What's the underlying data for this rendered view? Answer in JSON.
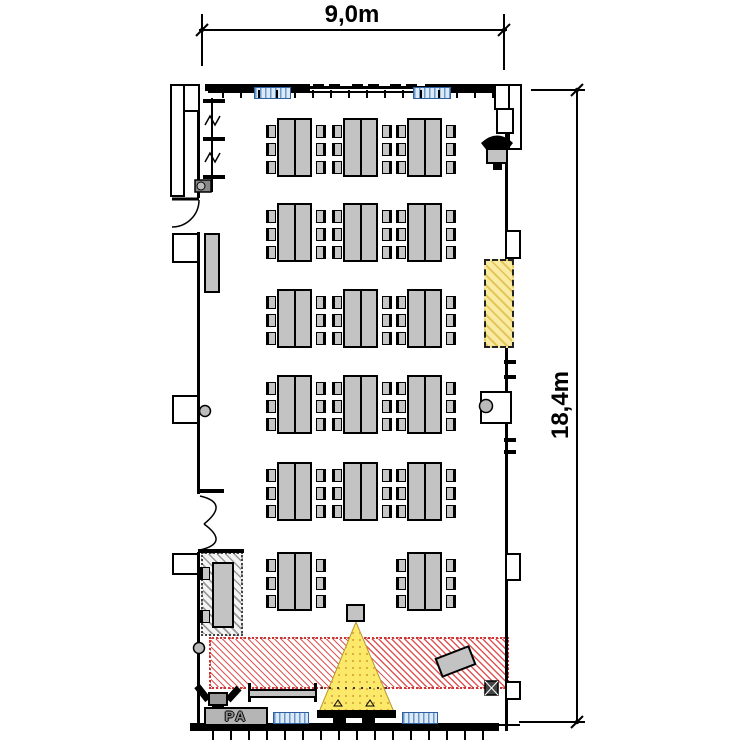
{
  "page": {
    "type": "architectural floor plan of seminar room with stage and projector",
    "background": "#ffffff"
  },
  "dimensions": {
    "width_label": "9,0m",
    "height_label": "18,4m"
  },
  "stage": {
    "pa_label": "PA"
  },
  "colors": {
    "wall": "#000000",
    "furniture_gray": "#c3c3c3",
    "stage_hatch_red": "#dd4444",
    "beam_yellow": "#fce96a",
    "wall_panel_yellow": "#f9eca2",
    "radiator_blue_fill": "#dceaf8",
    "radiator_blue_line": "#2f5f9e",
    "head_area_hatch_gray": "#9a9a9a"
  },
  "furniture": {
    "table_group": {
      "table_w": 35,
      "table_h": 59,
      "chair_w": 10,
      "chair_h": 13,
      "chair_offsets_y": [
        5,
        23,
        41
      ],
      "chairs_per_side": 3
    },
    "columns_x": [
      277,
      343,
      407
    ],
    "rows_y": [
      118,
      203,
      289,
      375,
      462
    ],
    "last_row": {
      "y": 552,
      "columns_x": [
        277,
        407
      ]
    },
    "head_table": {
      "x": 212,
      "y": 562,
      "w": 22,
      "h": 66,
      "chair_offsets_y": [
        5,
        48
      ]
    },
    "counts": {
      "table_groups": 17,
      "seats_per_group": 6,
      "head_table_seats": 2
    }
  }
}
